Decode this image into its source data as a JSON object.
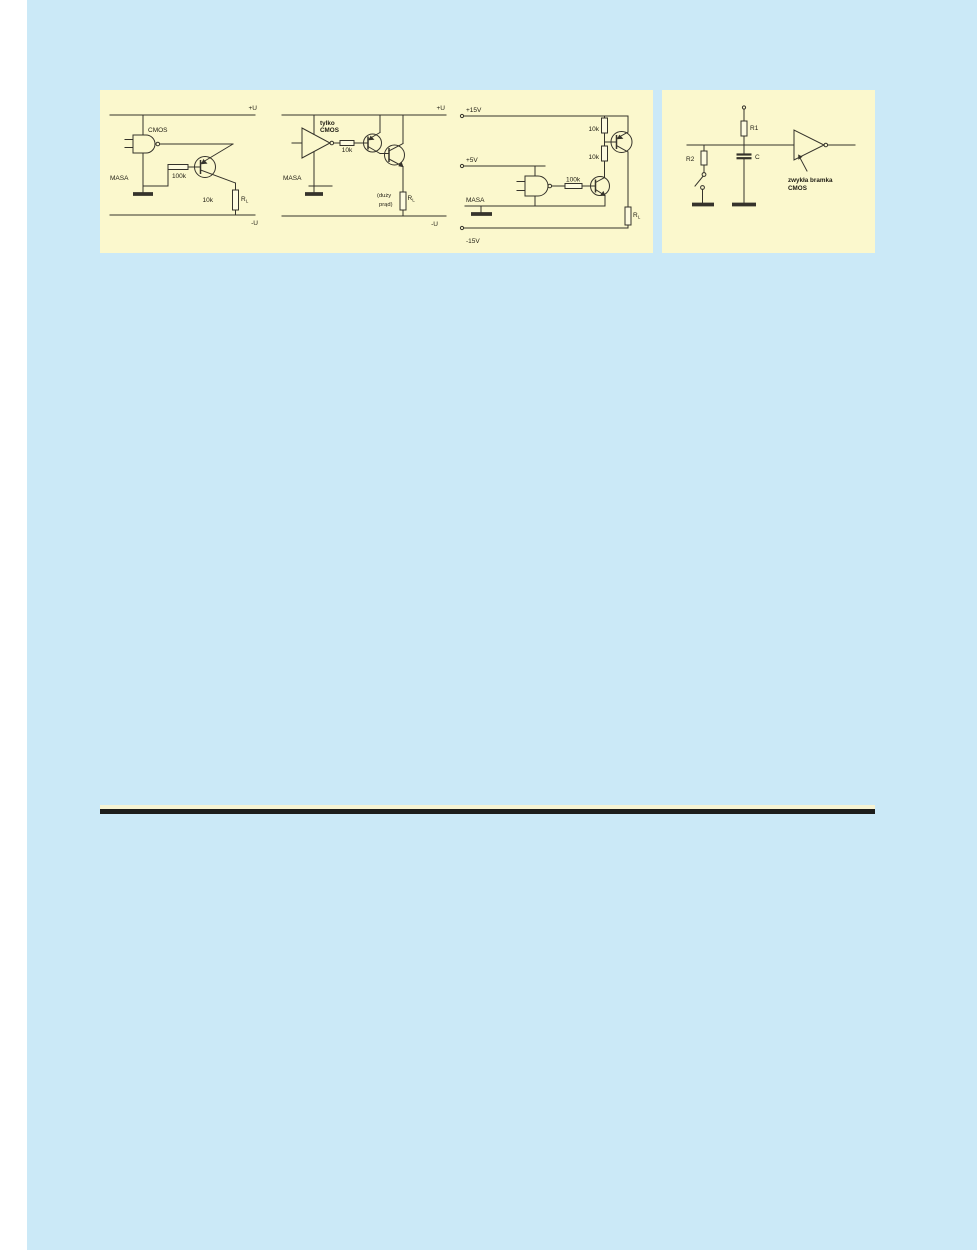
{
  "colors": {
    "page_margin": "#ffffff",
    "scan_background": "#cbe9f7",
    "figure_panel": "#fbf8cd",
    "schematic_ink": "#35332b",
    "rule_black": "#1d1d1b",
    "rule_cream": "#f6f3d3"
  },
  "circuit1": {
    "rail_top": "+U",
    "rail_bottom": "-U",
    "gate_label": "CMOS",
    "ground_label": "MASA",
    "base_resistor": "100k",
    "load_value": "10k",
    "load_name": "R",
    "load_sub": "L"
  },
  "circuit2": {
    "rail_top": "+U",
    "rail_bottom": "-U",
    "gate_label_1": "tylko",
    "gate_label_2": "CMOS",
    "series_resistor": "10k",
    "ground_label": "MASA",
    "note_1": "(duży",
    "note_2": "prąd)",
    "load_name": "R",
    "load_sub": "L"
  },
  "circuit3": {
    "rail_top": "+15V",
    "rail_mid": "+5V",
    "rail_bottom": "-15V",
    "ground_label": "MASA",
    "resistor_top": "10k",
    "resistor_mid": "10k",
    "base_resistor": "100k",
    "load_name": "R",
    "load_sub": "L"
  },
  "circuit4": {
    "r1": "R1",
    "r2": "R2",
    "cap": "C",
    "gate_label_1": "zwykła bramka",
    "gate_label_2": "CMOS"
  }
}
